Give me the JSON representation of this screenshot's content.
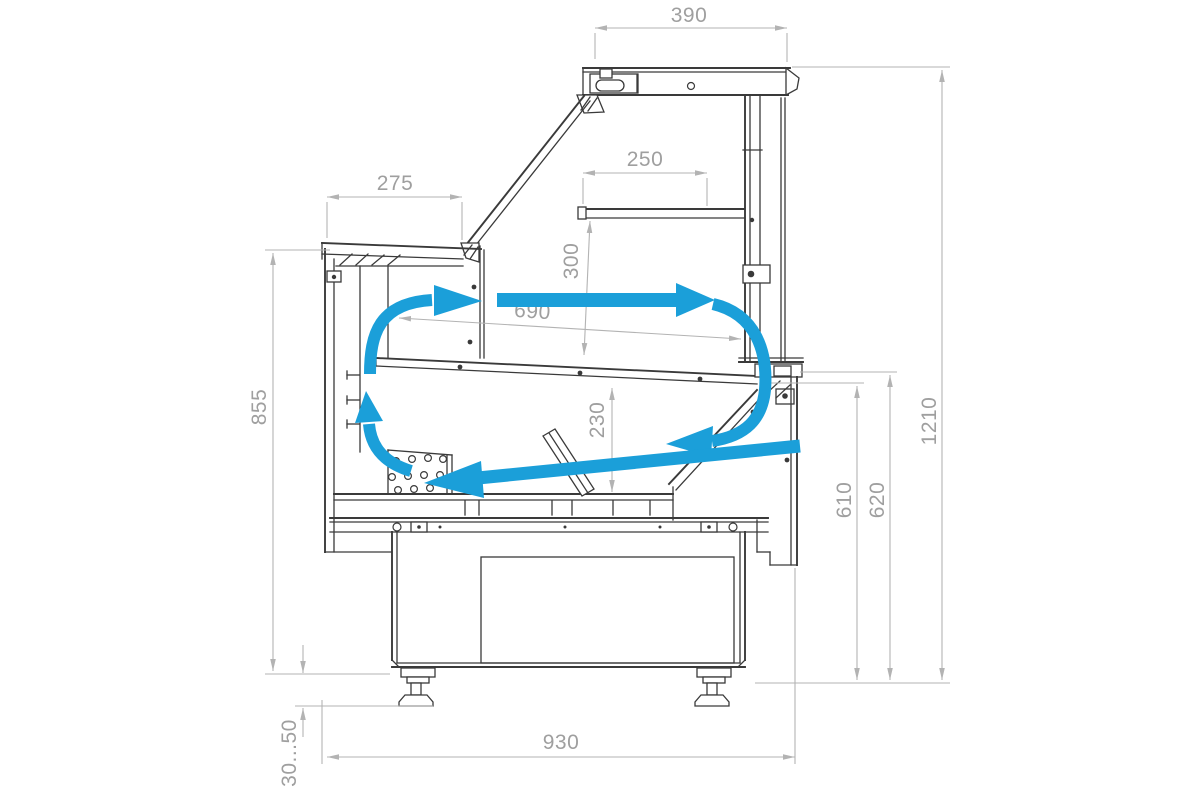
{
  "drawing": {
    "type": "technical-drawing",
    "subject": "Refrigerated serve-over display case — side cross-section with air circulation arrows and overall dimensions",
    "units": "mm"
  },
  "colors": {
    "background": "#ffffff",
    "structure_line": "#3a3a3a",
    "dimension_line": "#b3b3b3",
    "dimension_text": "#9f9f9f",
    "airflow": "#1b9fd9"
  },
  "dimensions": {
    "canopy_depth": "390",
    "shelf_depth": "250",
    "shelf_to_deck_height": "300",
    "front_counter_depth": "275",
    "display_opening_width": "690",
    "well_depth": "230",
    "front_counter_height": "855",
    "overall_height": "1210",
    "rear_opening_height_inner": "610",
    "rear_opening_height_outer": "620",
    "base_length": "930",
    "leg_adjustment_range": "30...50"
  }
}
